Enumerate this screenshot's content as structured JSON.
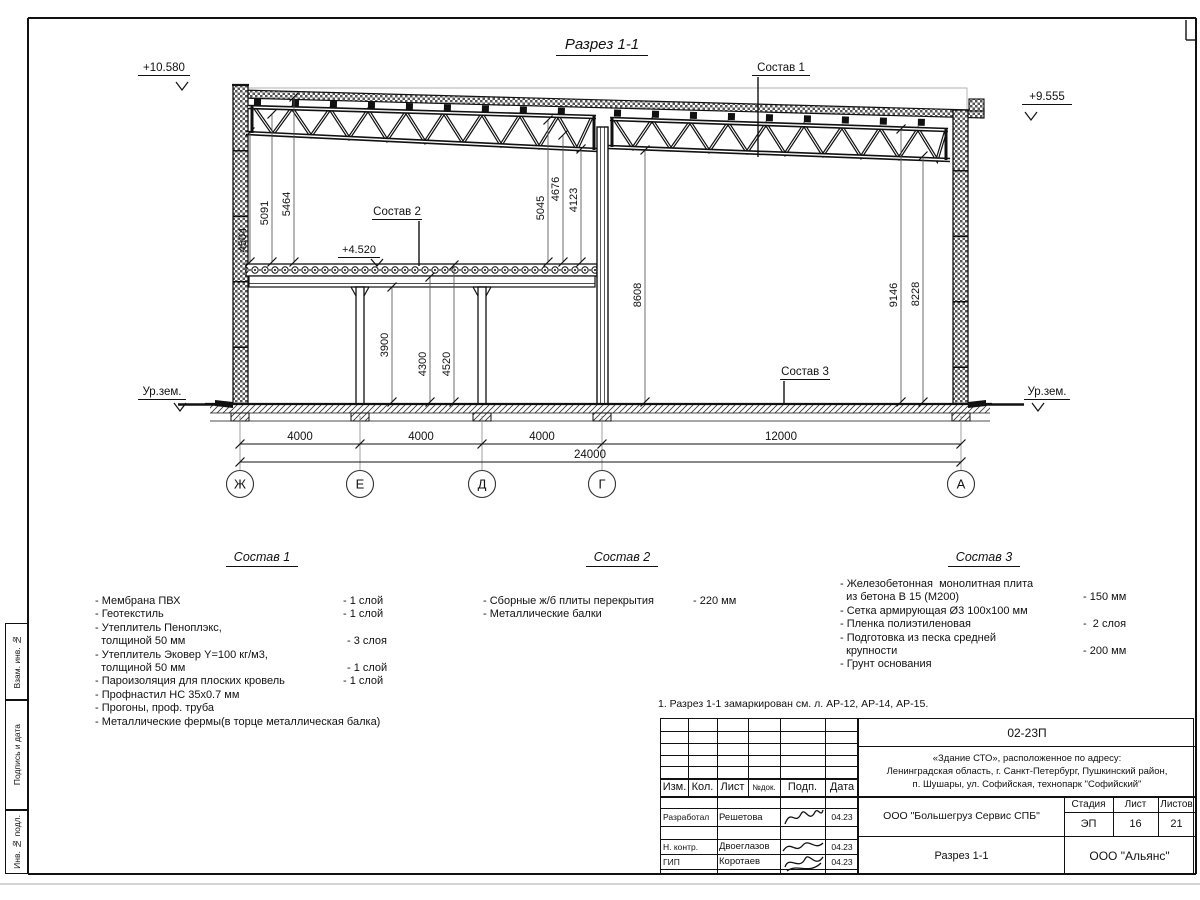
{
  "page": {
    "drawing_title": "Разрез 1-1"
  },
  "marks": {
    "lvl_roof_left": "+10.580",
    "lvl_roof_right": "+9.555",
    "lvl_floor": "+4.520",
    "ground_left": "Ур.зем.",
    "ground_right": "Ур.зем."
  },
  "callouts": {
    "c1": "Состав 1",
    "c2": "Состав 2",
    "c3": "Состав 3"
  },
  "vdims": {
    "d4504": "4504",
    "d5091": "5091",
    "d5464": "5464",
    "d5045": "5045",
    "d4676": "4676",
    "d4123": "4123",
    "d8608": "8608",
    "d9146": "9146",
    "d8228": "8228",
    "d3900": "3900",
    "d4300": "4300",
    "d4520": "4520"
  },
  "hdims": {
    "s1": "4000",
    "s2": "4000",
    "s3": "4000",
    "s4": "12000",
    "total": "24000"
  },
  "axes": {
    "a1": "Ж",
    "a2": "Е",
    "a3": "Д",
    "a4": "Г",
    "a5": "А"
  },
  "compositions": [
    {
      "title": "Состав 1",
      "items": [
        {
          "name": "- Мембрана ПВХ",
          "qty": "- 1 слой"
        },
        {
          "name": "- Геотекстиль",
          "qty": "- 1 слой"
        },
        {
          "name": "- Утеплитель Пеноплэкс,",
          "qty": ""
        },
        {
          "name": "  толщиной 50 мм",
          "qty": "- 3 слоя"
        },
        {
          "name": "- Утеплитель Эковер Y=100 кг/м3,",
          "qty": ""
        },
        {
          "name": "  толщиной 50 мм",
          "qty": "- 1 слой"
        },
        {
          "name": "- Пароизоляция для плоских кровель",
          "qty": "- 1 слой"
        },
        {
          "name": "- Профнастил НС 35х0.7 мм",
          "qty": ""
        },
        {
          "name": "- Прогоны, проф. труба",
          "qty": ""
        },
        {
          "name": "- Металлические фермы(в торце металлическая балка)",
          "qty": ""
        }
      ]
    },
    {
      "title": "Состав 2",
      "items": [
        {
          "name": "- Сборные ж/б плиты перекрытия",
          "qty": "- 220 мм"
        },
        {
          "name": "- Металлические балки",
          "qty": ""
        }
      ]
    },
    {
      "title": "Состав 3",
      "items": [
        {
          "name": "- Железобетонная  монолитная плита",
          "qty": ""
        },
        {
          "name": "  из бетона В 15 (М200)",
          "qty": "- 150 мм"
        },
        {
          "name": "- Сетка армирующая Ø3 100х100 мм",
          "qty": ""
        },
        {
          "name": "- Пленка полиэтиленовая",
          "qty": "-  2 слоя"
        },
        {
          "name": "- Подготовка из песка средней",
          "qty": ""
        },
        {
          "name": "  крупности",
          "qty": "- 200 мм"
        },
        {
          "name": "- Грунт основания",
          "qty": ""
        }
      ]
    }
  ],
  "note": "1. Разрез 1-1 замаркирован см. л. АР-12, АР-14, АР-15.",
  "titleblock": {
    "doc_number": "02-23П",
    "project_lines": [
      "«Здание СТО», расположенное по адресу:",
      "Ленинградская область, г. Санкт-Петербург, Пушкинский район,",
      "п. Шушары, ул. Софийская, технопарк \"Софийский\""
    ],
    "header_cols": [
      "Изм.",
      "Кол.",
      "Лист",
      "№док.",
      "Подп.",
      "Дата"
    ],
    "rows": [
      {
        "role": "Разработал",
        "name": "Решетова",
        "date": "04.23"
      },
      {
        "role": "Н. контр.",
        "name": "Двоеглазов",
        "date": "04.23"
      },
      {
        "role": "ГИП",
        "name": "Коротаев",
        "date": "04.23"
      }
    ],
    "client": "ООО \"Большегруз Сервис СПБ\"",
    "stage_label": "Стадия",
    "sheet_label": "Лист",
    "sheets_label": "Листов",
    "stage": "ЭП",
    "sheet": "16",
    "sheets": "21",
    "section_name": "Разрез 1-1",
    "company": "ООО \"Альянс\"",
    "side_labels": [
      "Взам. инв. №",
      "Подпись и дата",
      "Инв. № подл."
    ]
  }
}
